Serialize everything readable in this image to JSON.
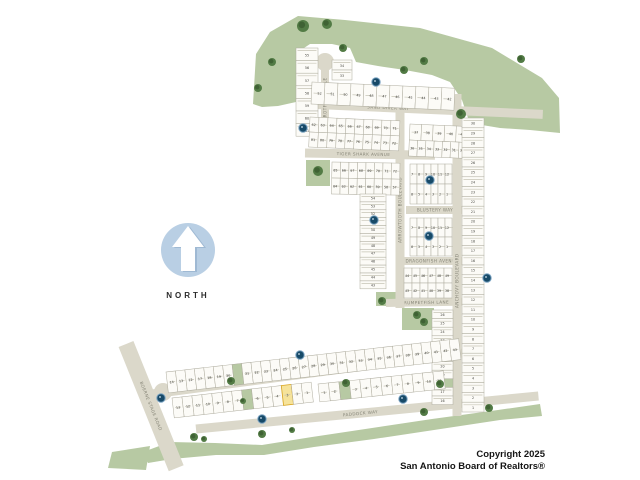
{
  "compass": {
    "label": "NORTH"
  },
  "copyright": {
    "line1": "Copyright 2025",
    "line2": "San Antonio Board of Realtors®"
  },
  "colors": {
    "background": "#ffffff",
    "greenspace": "#b7c9a3",
    "tree": "#527b45",
    "tree_dark": "#3f6234",
    "street": "#dbd8ca",
    "street_label": "#868577",
    "lot_fill": "#fcfbf7",
    "lot_stroke": "#adab9d",
    "lot_dash": "#c6c4b6",
    "lot_number": "#45453f",
    "marker_fill": "#174a68",
    "marker_ring": "#7aa3c2",
    "highlight_fill": "#f6e39a",
    "highlight_stroke": "#d9a520",
    "highlight_text": "#c93518",
    "compass_circle": "#b9cfe4",
    "compass_arrow": "#ffffff",
    "compass_arrow_shadow": "#9fb9d3"
  },
  "map": {
    "greens": {
      "polygons": [
        [
          [
            253,
            104
          ],
          [
            256,
            54
          ],
          [
            270,
            32
          ],
          [
            298,
            16
          ],
          [
            345,
            20
          ],
          [
            420,
            28
          ],
          [
            492,
            48
          ],
          [
            542,
            78
          ],
          [
            559,
            98
          ],
          [
            560,
            133
          ],
          [
            530,
            130
          ],
          [
            500,
            128
          ],
          [
            482,
            125
          ],
          [
            468,
            118
          ],
          [
            462,
            100
          ],
          [
            450,
            82
          ],
          [
            432,
            75
          ],
          [
            405,
            70
          ],
          [
            378,
            66
          ],
          [
            356,
            62
          ],
          [
            350,
            48
          ],
          [
            332,
            44
          ],
          [
            310,
            44
          ],
          [
            301,
            50
          ],
          [
            299,
            86
          ],
          [
            296,
            102
          ],
          [
            278,
            106
          ],
          [
            262,
            107
          ]
        ],
        [
          [
            143,
            452
          ],
          [
            170,
            442
          ],
          [
            215,
            443
          ],
          [
            262,
            445
          ],
          [
            312,
            437
          ],
          [
            372,
            428
          ],
          [
            432,
            419
          ],
          [
            498,
            410
          ],
          [
            540,
            404
          ],
          [
            542,
            416
          ],
          [
            500,
            420
          ],
          [
            434,
            430
          ],
          [
            374,
            439
          ],
          [
            314,
            447
          ],
          [
            264,
            455
          ],
          [
            216,
            455
          ],
          [
            172,
            459
          ],
          [
            148,
            463
          ]
        ],
        [
          [
            112,
            452
          ],
          [
            150,
            446
          ],
          [
            146,
            470
          ],
          [
            108,
            468
          ]
        ]
      ],
      "rects": [
        {
          "x": 306,
          "y": 160,
          "w": 24,
          "h": 26,
          "angle": 0
        },
        {
          "x": 370,
          "y": 182,
          "w": 28,
          "h": 9,
          "angle": 0
        },
        {
          "x": 376,
          "y": 292,
          "w": 20,
          "h": 14,
          "angle": 0
        },
        {
          "x": 402,
          "y": 308,
          "w": 32,
          "h": 22,
          "angle": 0
        }
      ],
      "trees": [
        [
          303,
          26,
          6
        ],
        [
          327,
          24,
          5
        ],
        [
          272,
          62,
          4
        ],
        [
          258,
          88,
          4
        ],
        [
          343,
          48,
          4
        ],
        [
          404,
          70,
          4
        ],
        [
          424,
          61,
          4
        ],
        [
          461,
          114,
          5
        ],
        [
          521,
          59,
          4
        ],
        [
          318,
          171,
          5
        ],
        [
          382,
          301,
          4
        ],
        [
          417,
          315,
          4
        ],
        [
          424,
          322,
          4
        ],
        [
          231,
          381,
          4
        ],
        [
          243,
          401,
          3
        ],
        [
          346,
          383,
          4
        ],
        [
          440,
          384,
          4
        ],
        [
          194,
          437,
          4
        ],
        [
          204,
          439,
          3
        ],
        [
          262,
          434,
          4
        ],
        [
          292,
          430,
          3
        ],
        [
          424,
          412,
          4
        ],
        [
          489,
          408,
          4
        ]
      ]
    },
    "streets": [
      {
        "name": "sand-diver-way",
        "label": "SAND DIVER WAY",
        "x": 305,
        "y": 104,
        "angle": 2.5,
        "length": 238,
        "width": 9,
        "label_at": 0.35
      },
      {
        "name": "tiger-shark-avenue",
        "label": "TIGER SHARK AVENUE",
        "x": 305,
        "y": 153,
        "angle": 1,
        "length": 130,
        "width": 9,
        "label_at": 0.45
      },
      {
        "name": "blustery-way",
        "label": "BLUSTERY WAY",
        "x": 406,
        "y": 210,
        "angle": 0,
        "length": 58,
        "width": 8,
        "label_at": 0.5
      },
      {
        "name": "dragonfish-avenue",
        "label": "DRAGONFISH AVENUE",
        "x": 400,
        "y": 261,
        "angle": 0,
        "length": 64,
        "width": 8,
        "label_at": 0.5
      },
      {
        "name": "trumpetfish-lane",
        "label": "TRUMPETFISH LANE",
        "x": 386,
        "y": 303,
        "angle": -1,
        "length": 78,
        "width": 8,
        "label_at": 0.5
      },
      {
        "name": "arrowtooth-boulevard",
        "label": "ARROWTOOTH BOULEVARD",
        "x": 400,
        "y": 308,
        "angle": -90,
        "length": 196,
        "width": 9,
        "label_at": 0.5
      },
      {
        "name": "parrotfish-circle",
        "label": "PARROTFISH CIRCLE",
        "x": 325,
        "y": 140,
        "angle": -90,
        "length": 76,
        "width": 8,
        "label_at": 0.5
      },
      {
        "name": "anchovy-boulevard",
        "label": "ANCHOVY BOULEVARD",
        "x": 457,
        "y": 416,
        "angle": -90,
        "length": 322,
        "width": 9,
        "label_at": 0.42
      },
      {
        "name": "velvetfin-boulevard",
        "label": "VELVETFIN BOULEVARD",
        "x": 152,
        "y": 394,
        "angle": -7.5,
        "length": 320,
        "width": 9,
        "label_at": 0.45
      },
      {
        "name": "paddock-way",
        "label": "PADDOCK WAY",
        "x": 196,
        "y": 429,
        "angle": -5.5,
        "length": 344,
        "width": 9,
        "label_at": 0.48
      },
      {
        "name": "boerne-stage-road",
        "label": "BOERNE STAGE ROAD",
        "x": 126,
        "y": 344,
        "angle": 68,
        "length": 134,
        "width": 16,
        "label_at": 0.5
      }
    ],
    "culdesacs": [
      [
        325,
        62,
        9
      ],
      [
        163,
        392,
        9
      ]
    ],
    "blocks": [
      {
        "name": "parrotfish-west",
        "type": "vcol",
        "x": 296,
        "y": 48,
        "width": 22,
        "lot_h": 12.6,
        "numbers": [
          "55",
          "56",
          "57",
          "58",
          "59",
          "60",
          "61"
        ]
      },
      {
        "name": "parrotfish-east",
        "type": "vcol",
        "x": 332,
        "y": 60,
        "width": 20,
        "lot_h": 10,
        "numbers": [
          "34",
          "33"
        ]
      },
      {
        "name": "sand-diver-north",
        "type": "hrow",
        "x": 312,
        "y": 82,
        "angle": 2.5,
        "depth": 22,
        "rows": [
          {
            "lot_w": 13,
            "numbers": [
              "52",
              "51",
              "50",
              "49",
              "48",
              "47",
              "46",
              "45",
              "44",
              "43",
              "42"
            ]
          }
        ]
      },
      {
        "name": "sand-diver-south",
        "type": "hrow",
        "x": 310,
        "y": 117,
        "angle": 2.5,
        "depth": 15,
        "rows": [
          {
            "lot_w": 9,
            "numbers": [
              "62",
              "63",
              "64",
              "65",
              "66",
              "67",
              "68",
              "69",
              "70",
              "71"
            ]
          },
          {
            "lot_w": 9,
            "numbers": [
              "81",
              "80",
              "79",
              "78",
              "77",
              "76",
              "75",
              "74",
              "73",
              "72"
            ]
          }
        ]
      },
      {
        "name": "east-upper",
        "type": "hrow",
        "x": 410,
        "y": 124,
        "angle": 2.5,
        "depth": 16,
        "rows": [
          {
            "lot_w": 11.6,
            "numbers": [
              "37",
              "38",
              "39",
              "40",
              "41"
            ]
          },
          {
            "lot_w": 8.3,
            "numbers": [
              "36",
              "35",
              "34",
              "33",
              "32",
              "31",
              "30"
            ]
          }
        ]
      },
      {
        "name": "tiger-shark-south",
        "type": "hrow",
        "x": 332,
        "y": 162,
        "angle": 1,
        "depth": 16,
        "rows": [
          {
            "lot_w": 8.5,
            "numbers": [
              "65",
              "66",
              "67",
              "68",
              "69",
              "70",
              "71",
              "72"
            ]
          },
          {
            "lot_w": 8.5,
            "numbers": [
              "64",
              "63",
              "62",
              "61",
              "60",
              "59",
              "58",
              "57"
            ]
          }
        ]
      },
      {
        "name": "arrowtooth-west",
        "type": "vcol",
        "x": 360,
        "y": 194,
        "width": 26,
        "lot_h": 7.9,
        "numbers": [
          "54",
          "53",
          "52",
          "51",
          "50",
          "49",
          "48",
          "47",
          "46",
          "45",
          "44",
          "43"
        ]
      },
      {
        "name": "blustery-north",
        "type": "hrow",
        "x": 410,
        "y": 164,
        "angle": 0,
        "depth": 20,
        "rows": [
          {
            "lot_w": 7,
            "numbers": [
              "7",
              "8",
              "9",
              "10",
              "11",
              "12"
            ]
          },
          {
            "lot_w": 7,
            "numbers": [
              "6",
              "5",
              "4",
              "3",
              "2",
              "1"
            ]
          }
        ]
      },
      {
        "name": "blustery-south",
        "type": "hrow",
        "x": 410,
        "y": 218,
        "angle": 0,
        "depth": 19,
        "rows": [
          {
            "lot_w": 7,
            "numbers": [
              "7",
              "8",
              "9",
              "10",
              "11",
              "12"
            ]
          },
          {
            "lot_w": 7,
            "numbers": [
              "6",
              "5",
              "4",
              "3",
              "2",
              "1"
            ]
          }
        ]
      },
      {
        "name": "dragonfish-south",
        "type": "hrow",
        "x": 404,
        "y": 268,
        "angle": 0,
        "depth": 15,
        "rows": [
          {
            "lot_w": 8,
            "numbers": [
              "44",
              "45",
              "46",
              "47",
              "48",
              "49"
            ]
          },
          {
            "lot_w": 8,
            "numbers": [
              "43",
              "42",
              "41",
              "40",
              "39",
              "38"
            ]
          }
        ]
      },
      {
        "name": "east-column",
        "type": "vcol",
        "x": 462,
        "y": 118,
        "width": 22,
        "lot_h": 9.8,
        "numbers": [
          "30",
          "29",
          "28",
          "27",
          "26",
          "25",
          "24",
          "23",
          "22",
          "21",
          "20",
          "19",
          "18",
          "17",
          "16",
          "15",
          "14",
          "13",
          "12",
          "11",
          "10",
          "9",
          "8",
          "7",
          "6",
          "5",
          "4",
          "3",
          "2",
          "1"
        ]
      },
      {
        "name": "anchovy-west-column",
        "type": "vcol",
        "x": 432,
        "y": 310,
        "width": 21,
        "lot_h": 8.6,
        "numbers": [
          "26",
          "25",
          "24",
          "23",
          "22",
          "21",
          "20",
          "19",
          "G",
          "17",
          "16"
        ]
      },
      {
        "name": "velvetfin-north-row",
        "type": "hrow",
        "x": 166,
        "y": 372,
        "angle": -6.5,
        "depth": 21,
        "rows": [
          {
            "lot_w": 9.5,
            "numbers": [
              "14",
              "13",
              "12",
              "17",
              "18",
              "19",
              "20",
              "G",
              "21",
              "22",
              "23",
              "24",
              "25",
              "26",
              "27",
              "28",
              "29",
              "30",
              "31",
              "32",
              "33",
              "34",
              "35",
              "36",
              "37",
              "38",
              "39",
              "40",
              "41",
              "42",
              "43"
            ]
          }
        ]
      },
      {
        "name": "velvetfin-south-row",
        "type": "hrow",
        "x": 172,
        "y": 398,
        "angle": -6.5,
        "depth": 20,
        "rows": [
          {
            "lot_w": 10,
            "numbers": [
              "13",
              "12",
              "11",
              "10",
              "9",
              "8",
              "7",
              "G",
              "6",
              "5",
              "4",
              "3",
              "2",
              "1"
            ]
          }
        ],
        "highlight": {
          "row": 0,
          "index": 11
        }
      },
      {
        "name": "paddock-north-row",
        "type": "hrow",
        "x": 318,
        "y": 384,
        "angle": -6,
        "depth": 18,
        "rows": [
          {
            "lot_w": 10.5,
            "numbers": [
              "1",
              "2",
              "G",
              "3",
              "4",
              "5",
              "6",
              "7",
              "8",
              "9",
              "10",
              "11"
            ]
          }
        ]
      }
    ],
    "markers": [
      [
        376,
        82
      ],
      [
        303,
        128
      ],
      [
        430,
        180
      ],
      [
        374,
        220
      ],
      [
        429,
        236
      ],
      [
        487,
        278
      ],
      [
        300,
        355
      ],
      [
        161,
        398
      ],
      [
        262,
        419
      ],
      [
        403,
        399
      ]
    ]
  }
}
